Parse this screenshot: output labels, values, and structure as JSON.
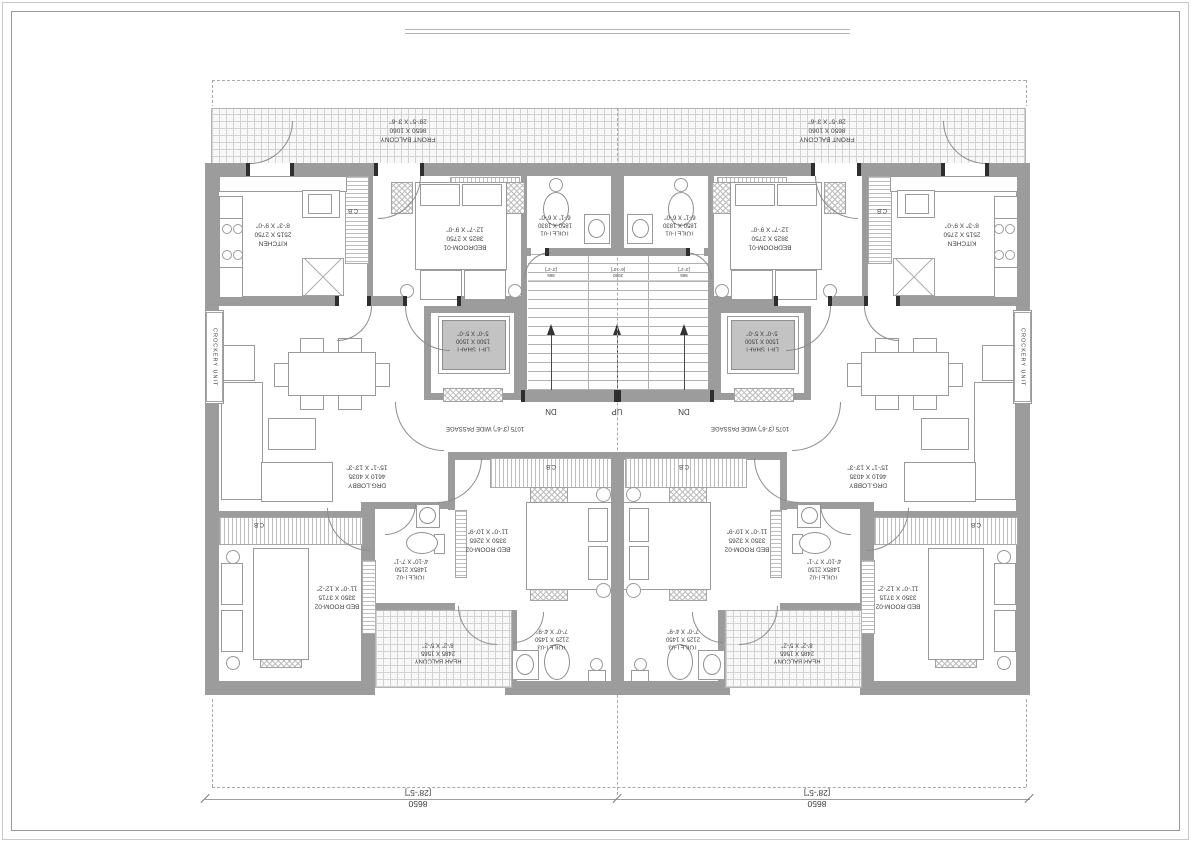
{
  "labels": {
    "front_balcony": {
      "name": "FRONT BALCONY",
      "mm": "8650 X 1060",
      "ft": "28'-5\" X 3'-6\""
    },
    "kitchen": {
      "name": "KITCHEN",
      "mm": "2515 X 2750",
      "ft": "8'-3\" X 9'-0\""
    },
    "bedroom_01": {
      "name": "BEDROOM-01",
      "mm": "3825 X 2750",
      "ft": "12'-7\" X 9'-0\""
    },
    "toilet_01": {
      "name": "TOILET-01",
      "mm": "1850 X 1830",
      "ft": "6'-1\" X 6'-0\""
    },
    "lift_shaft": {
      "name": "LIFT SHAFT",
      "mm": "1500 X 1500",
      "ft": "5'-0\" X 5'-0\""
    },
    "drg_lobby": {
      "name": "DRG.LOBBY",
      "mm": "4610 X 4035",
      "ft": "15'-1\" X 13'-3\""
    },
    "bed_room_02_a": {
      "name": "BED ROOM-02",
      "mm": "3350 X 3715",
      "ft": "11'-0\" X 12'-2\""
    },
    "bed_room_02_b": {
      "name": "BED ROOM-02",
      "mm": "3350 X 3265",
      "ft": "11'-0\" X 10'-9\""
    },
    "toilet_02": {
      "name": "TOILET-02",
      "mm": "1485X 2150",
      "ft": "4'-10\" X 7'-1\""
    },
    "toilet_03": {
      "name": "TOILET-03",
      "mm": "2125 X 1450",
      "ft": "7'-0\" X 4'-9\""
    },
    "rear_balcony": {
      "name": "REAR BALCONY",
      "mm": "2485 X 1565",
      "ft": "8'-2\" X 5'-2\""
    },
    "passage": "1075 (3'-6\") WIDE PASSAGE",
    "crockery": "CROCKERY UNIT",
    "cb": "C.B"
  },
  "stair": {
    "up": "UP",
    "dn": "DN",
    "flight_width_mm": "965",
    "flight_width_ft": "[3'-2\"]",
    "landing_mm": "2080",
    "landing_ft": "[6'-10\"]"
  },
  "dimensions": {
    "unit_width_mm": "8650",
    "unit_width_ft": "[28'-5\"]"
  },
  "colors": {
    "wall": "#9c9c9c",
    "hatch_line": "#c8c8c8",
    "text": "#3d3d3d"
  }
}
